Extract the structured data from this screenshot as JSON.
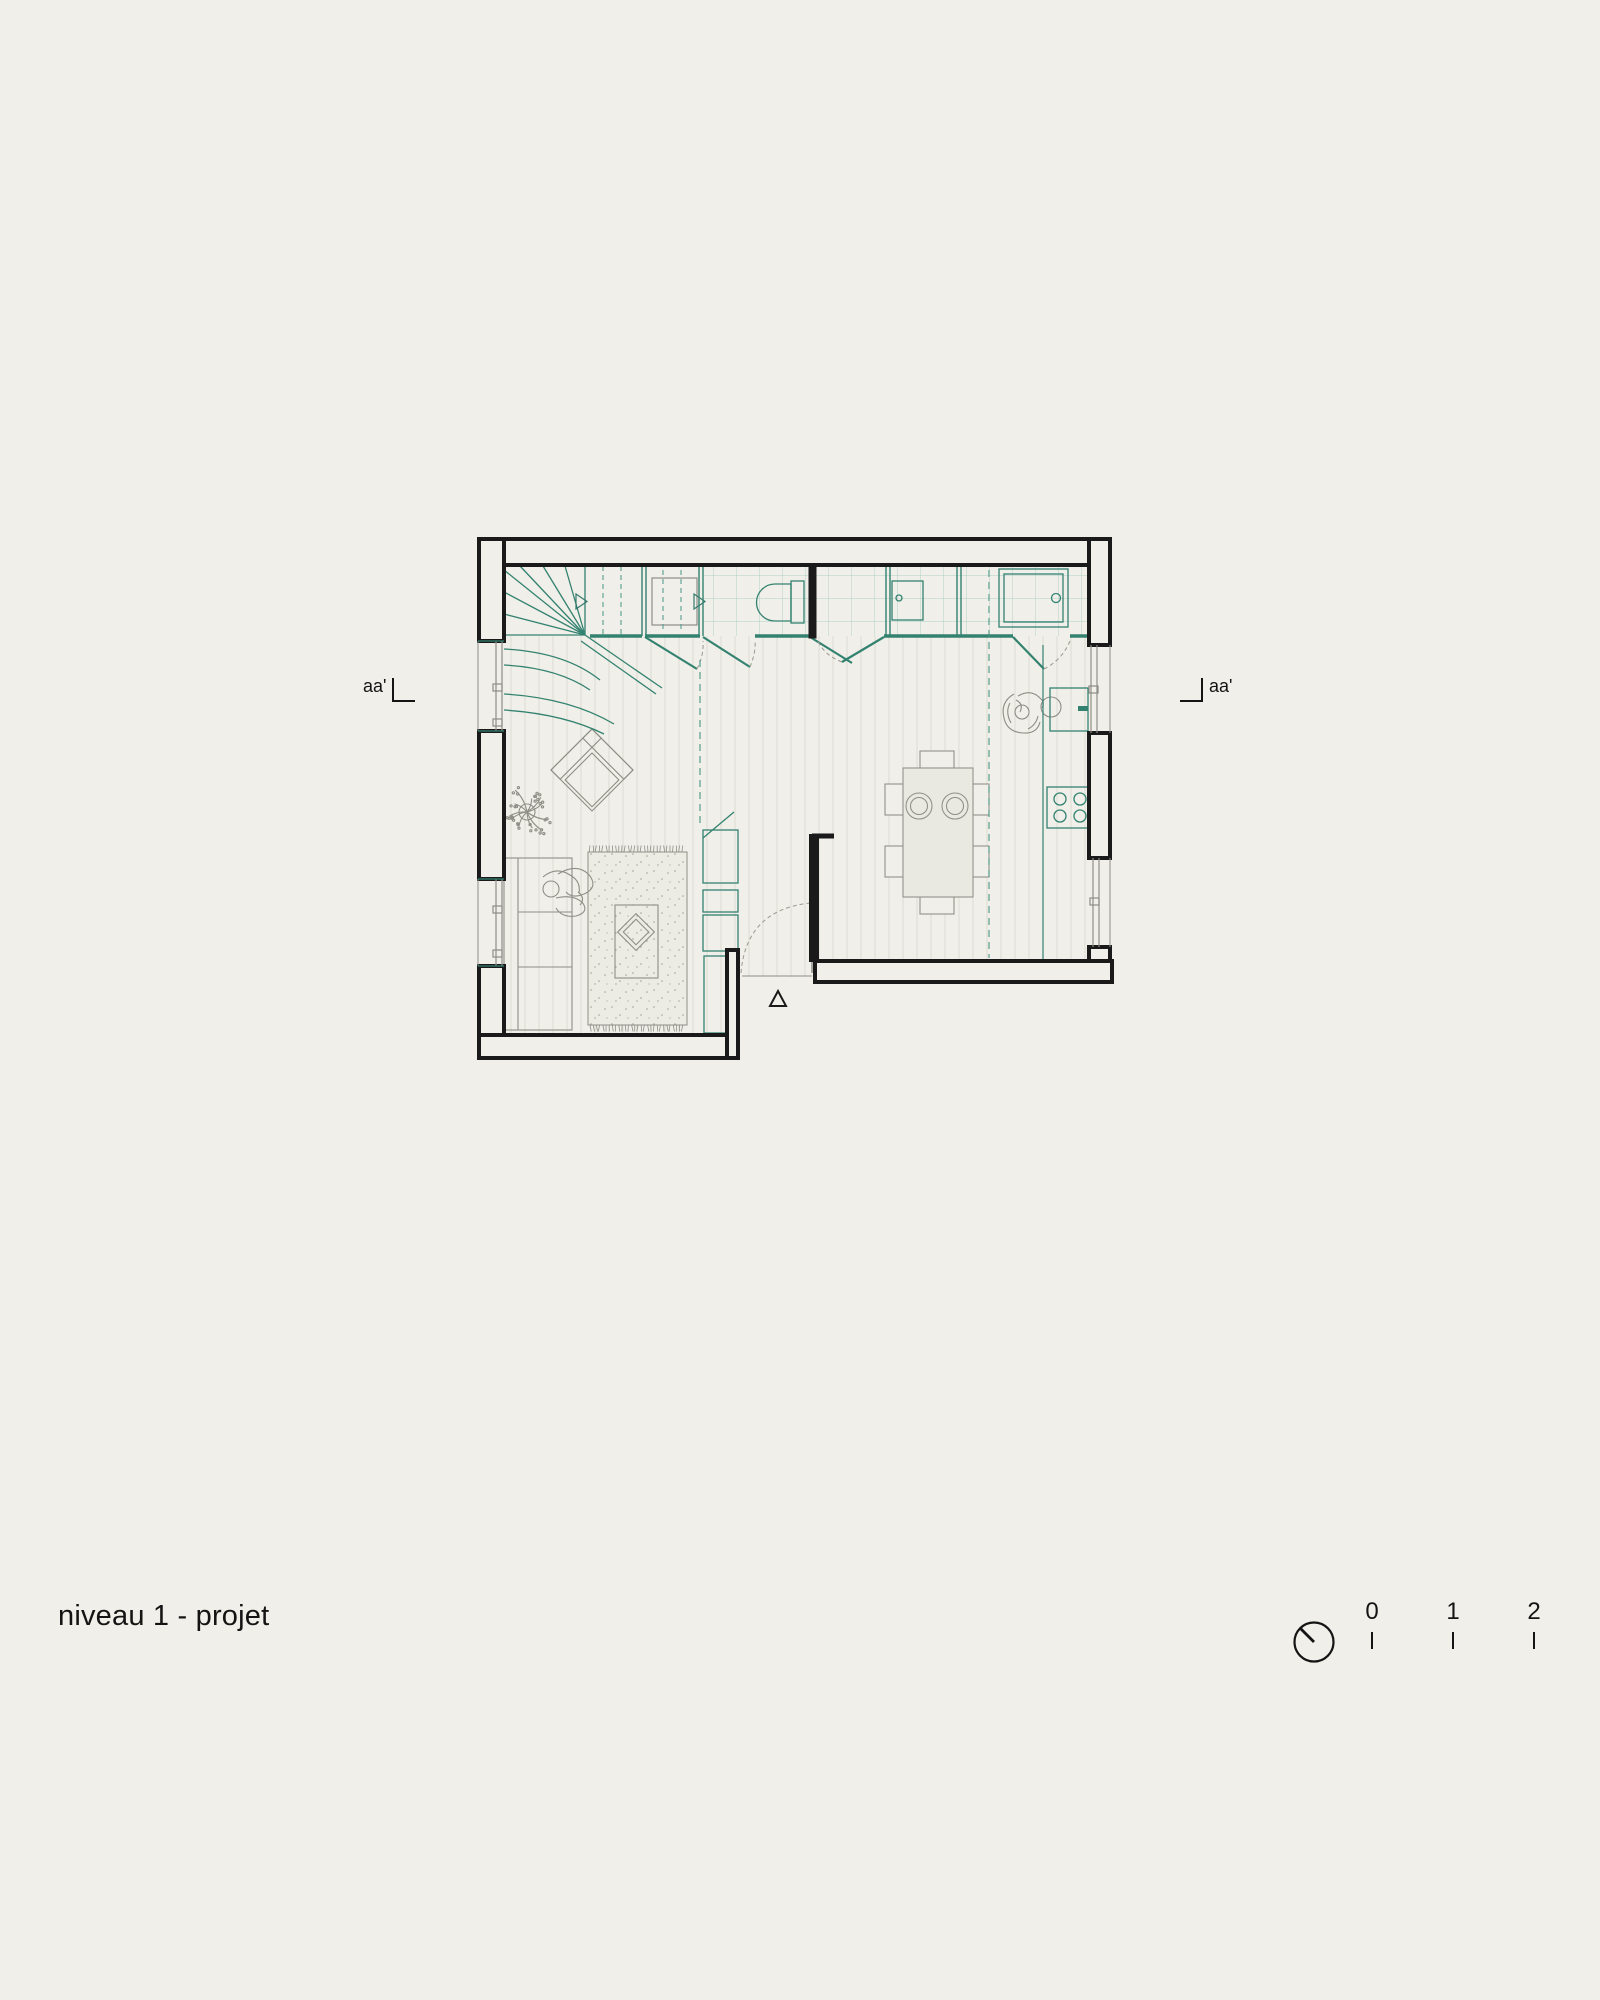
{
  "title": {
    "text": "niveau 1 - projet"
  },
  "section_markers": {
    "left": {
      "label": "aa'"
    },
    "right": {
      "label": "aa'"
    }
  },
  "scalebar": {
    "labels": [
      "0",
      "1",
      "2"
    ],
    "unit_px": 80
  },
  "icons": {
    "north": "compass-circle-icon"
  },
  "colors": {
    "paper": "#f0efe9",
    "ink": "#1a1a1a",
    "teal": "#338270",
    "teal_dash": "#4a9585",
    "tile": "#abd0c5",
    "furniture_gray": "#8e8e87",
    "wood_line": "#dcdbd2",
    "fill_light": "#e9e8e1"
  }
}
